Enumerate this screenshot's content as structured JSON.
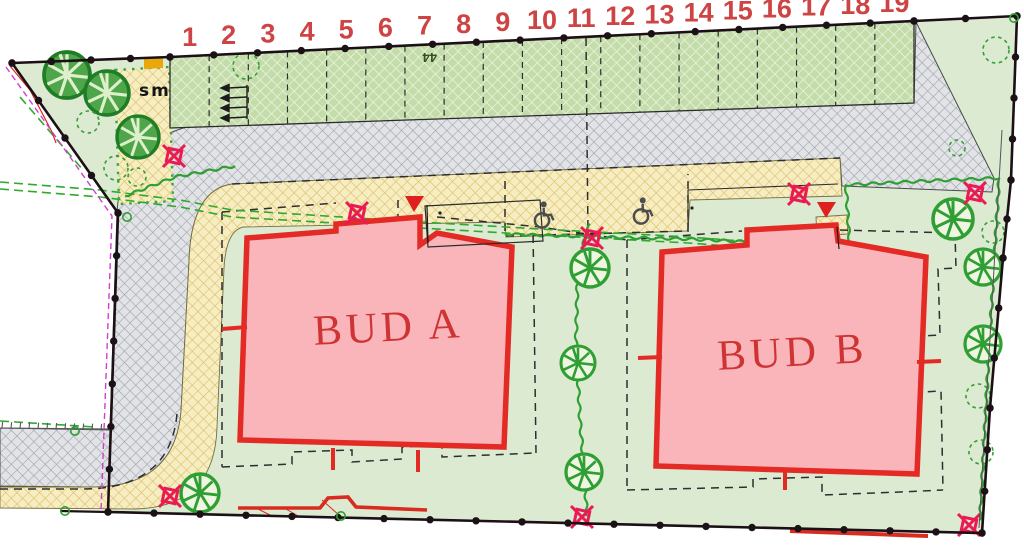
{
  "plan": {
    "buildings": {
      "a": {
        "label": "BUD A"
      },
      "b": {
        "label": "BUD B"
      }
    },
    "annotations": {
      "waste_enclosure_label": "sm",
      "adjacent_plot_number": "44"
    },
    "parking": {
      "numbers": [
        "1",
        "2",
        "3",
        "4",
        "5",
        "6",
        "7",
        "8",
        "9",
        "10",
        "11",
        "12",
        "13",
        "14",
        "15",
        "16",
        "17",
        "18",
        "19"
      ]
    },
    "icons": {
      "street_lamp": "square-with-x-lamp-icon",
      "tree": "tree-crown-icon",
      "shrub": "dashed-shrub-icon",
      "disabled_parking": "wheelchair-icon",
      "entrance": "red-triangle-entrance-icon"
    },
    "colors": {
      "building_fill": "#f9b5b9",
      "building_outline": "#e42a24",
      "site_green": "#dcead2",
      "parking_hatch": "#c3dcaa",
      "road_hatch": "#e2e3e6",
      "path_hatch": "#f7edc2",
      "boundary": "#1b1016",
      "lamp": "#ea1a52",
      "vegetation": "#2f9e33",
      "survey_magenta": "#cf3fd0",
      "number_red": "#ce4343"
    }
  }
}
